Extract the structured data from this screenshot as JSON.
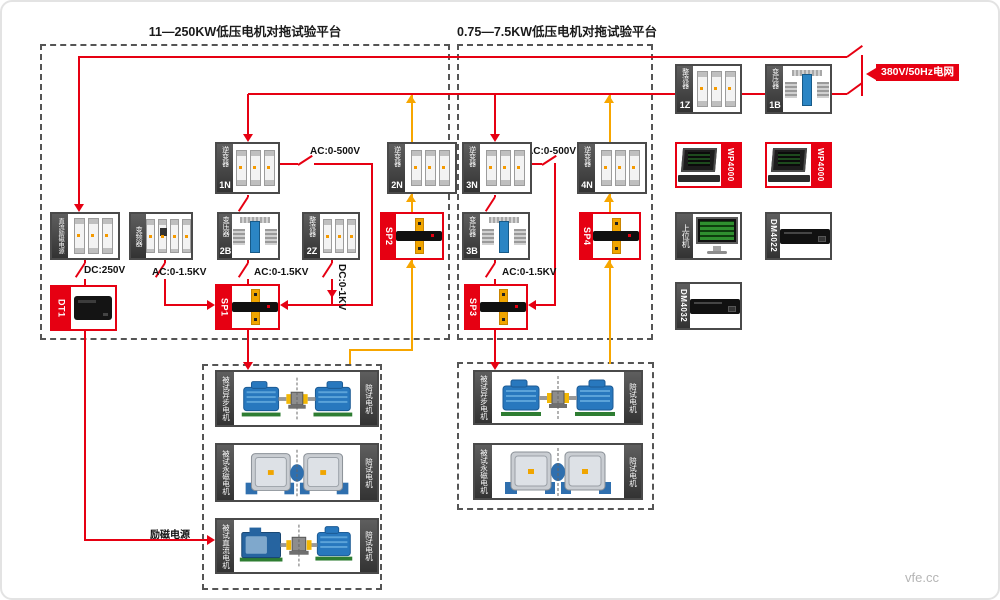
{
  "watermark": "vfe.cc",
  "colors": {
    "wire_red": "#e60012",
    "wire_orange": "#f7a600",
    "strip_dark": "#3f3f3f",
    "panel_red": "#e60012"
  },
  "platform_left": {
    "title": "11—250KW低压电机对拖试验平台"
  },
  "platform_right": {
    "title": "0.75—7.5KW低压电机对拖试验平台"
  },
  "grid": {
    "label": "380V/50Hz电网"
  },
  "components": {
    "n1": {
      "tag": "逆变器",
      "id": "1N"
    },
    "n2": {
      "tag": "逆变器",
      "id": "2N"
    },
    "n3": {
      "tag": "逆变器",
      "id": "3N"
    },
    "n4": {
      "tag": "逆变器",
      "id": "4N"
    },
    "z1": {
      "tag": "整流器",
      "id": "1Z"
    },
    "z2": {
      "tag": "整流器",
      "id": "2Z"
    },
    "b1": {
      "tag": "变压器",
      "id": "1B"
    },
    "b2": {
      "tag": "变压器",
      "id": "2B"
    },
    "b3": {
      "tag": "变压器",
      "id": "3B"
    },
    "vfd": {
      "tag": "变频器"
    },
    "dc_exc": {
      "tag": "直流励磁电源"
    },
    "sp1": {
      "id": "SP1"
    },
    "sp2": {
      "id": "SP2"
    },
    "sp3": {
      "id": "SP3"
    },
    "sp4": {
      "id": "SP4"
    },
    "dt1": {
      "id": "DT1"
    },
    "wp_a": {
      "id": "WP4000"
    },
    "wp_b": {
      "id": "WP4000"
    },
    "host": {
      "tag": "上位机"
    },
    "dm4022": {
      "id": "DM4022"
    },
    "dm4032": {
      "id": "DM4032"
    }
  },
  "wire_labels": {
    "ac500_left": "AC:0-500V",
    "ac500_right": "AC:0-500V",
    "ac15_vfd": "AC:0-1.5KV",
    "ac15_b2": "AC:0-1.5KV",
    "ac15_b3": "AC:0-1.5KV",
    "dc1kv": "DC:0-1KV",
    "dc250": "DC:250V",
    "excitation": "励磁电源"
  },
  "motor_rows": {
    "left": [
      {
        "test": "被试异步电机",
        "companion": "陪试电机"
      },
      {
        "test": "被试永磁电机",
        "companion": "陪试电机"
      },
      {
        "test": "被试直流电机",
        "companion": "陪试电机"
      }
    ],
    "right": [
      {
        "test": "被试异步电机",
        "companion": "陪试电机"
      },
      {
        "test": "被试永磁电机",
        "companion": "陪试电机"
      }
    ]
  }
}
